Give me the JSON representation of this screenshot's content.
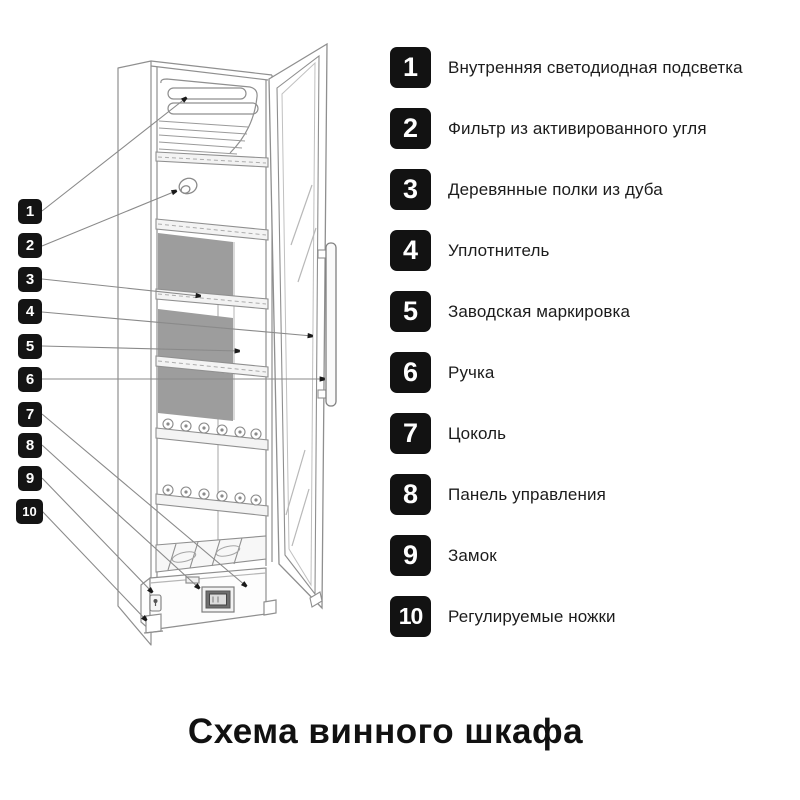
{
  "title": "Схема винного шкафа",
  "legend": {
    "items": [
      {
        "number": "1",
        "label": "Внутренняя светодиодная подсветка"
      },
      {
        "number": "2",
        "label": "Фильтр из активированного угля"
      },
      {
        "number": "3",
        "label": "Деревянные полки из дуба"
      },
      {
        "number": "4",
        "label": "Уплотнитель"
      },
      {
        "number": "5",
        "label": "Заводская маркировка"
      },
      {
        "number": "6",
        "label": "Ручка"
      },
      {
        "number": "7",
        "label": "Цоколь"
      },
      {
        "number": "8",
        "label": "Панель управления"
      },
      {
        "number": "9",
        "label": "Замок"
      },
      {
        "number": "10",
        "label": "Регулируемые ножки"
      }
    ]
  },
  "callouts": {
    "numbers": [
      "1",
      "2",
      "3",
      "4",
      "5",
      "6",
      "7",
      "8",
      "9",
      "10"
    ]
  },
  "colors": {
    "badge_background": "#121212",
    "badge_text": "#ffffff",
    "drawing_line": "#8f8f8f",
    "leader_line": "#8a8a8a",
    "arrow_marker": "#1a1a1a",
    "back_panel_gray": "#9d9d9d",
    "text": "#1c1c1c",
    "background": "#ffffff"
  }
}
